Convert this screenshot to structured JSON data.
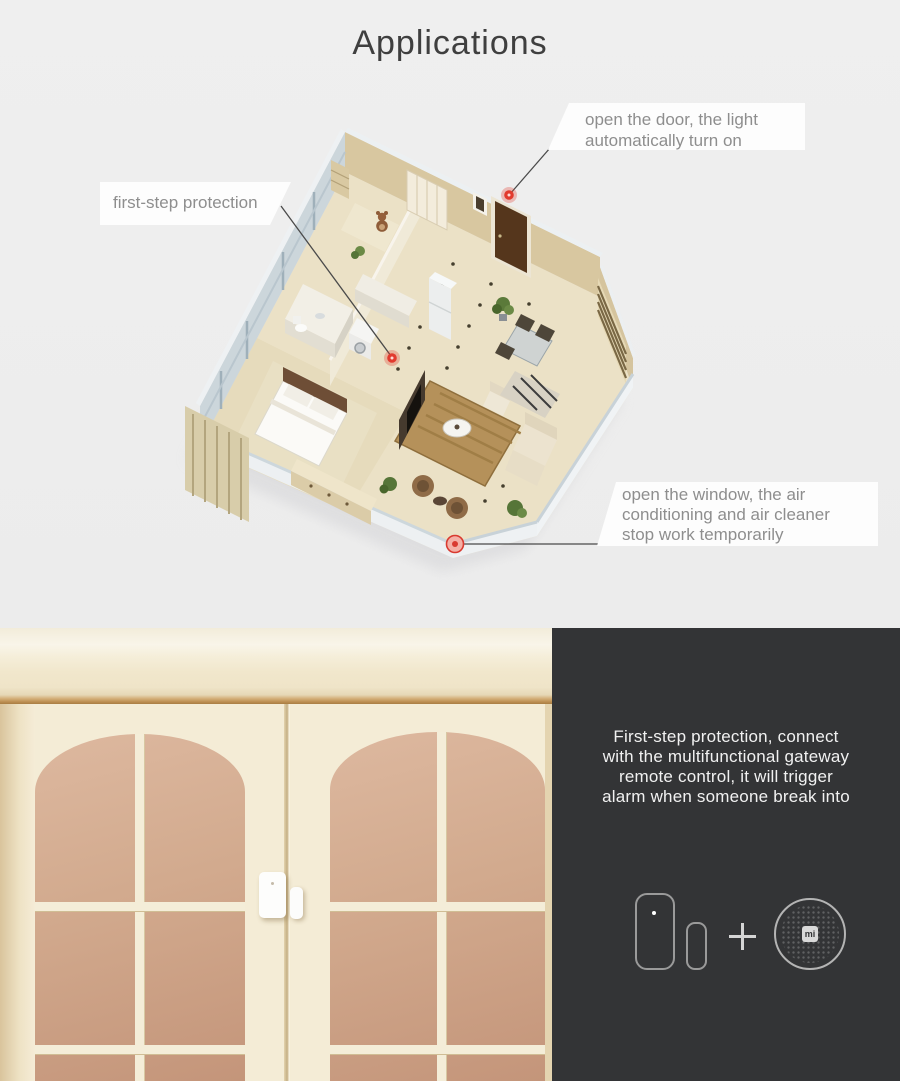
{
  "title": "Applications",
  "callouts": {
    "door": {
      "lines": [
        "open the door, the light",
        "automatically turn on"
      ]
    },
    "first_step": {
      "text": "first-step protection"
    },
    "window": {
      "lines": [
        "open the window, the air",
        "conditioning and air cleaner",
        "stop work temporarily"
      ]
    }
  },
  "panel": {
    "lines": [
      "First-step protection, connect",
      "with the multifunctional gateway",
      "remote control, it will trigger",
      "alarm when someone break into"
    ],
    "plus_label": "+",
    "gateway_logo": "mi"
  },
  "icons": {
    "sensor": "door-window-sensor-icon",
    "magnet": "sensor-magnet-icon",
    "gateway": "mi-gateway-icon"
  },
  "colors": {
    "marker_red": "#e23a2e",
    "panel_bg": "#333436",
    "page_bg": "#ededee",
    "door_glass": "#cfa286"
  }
}
